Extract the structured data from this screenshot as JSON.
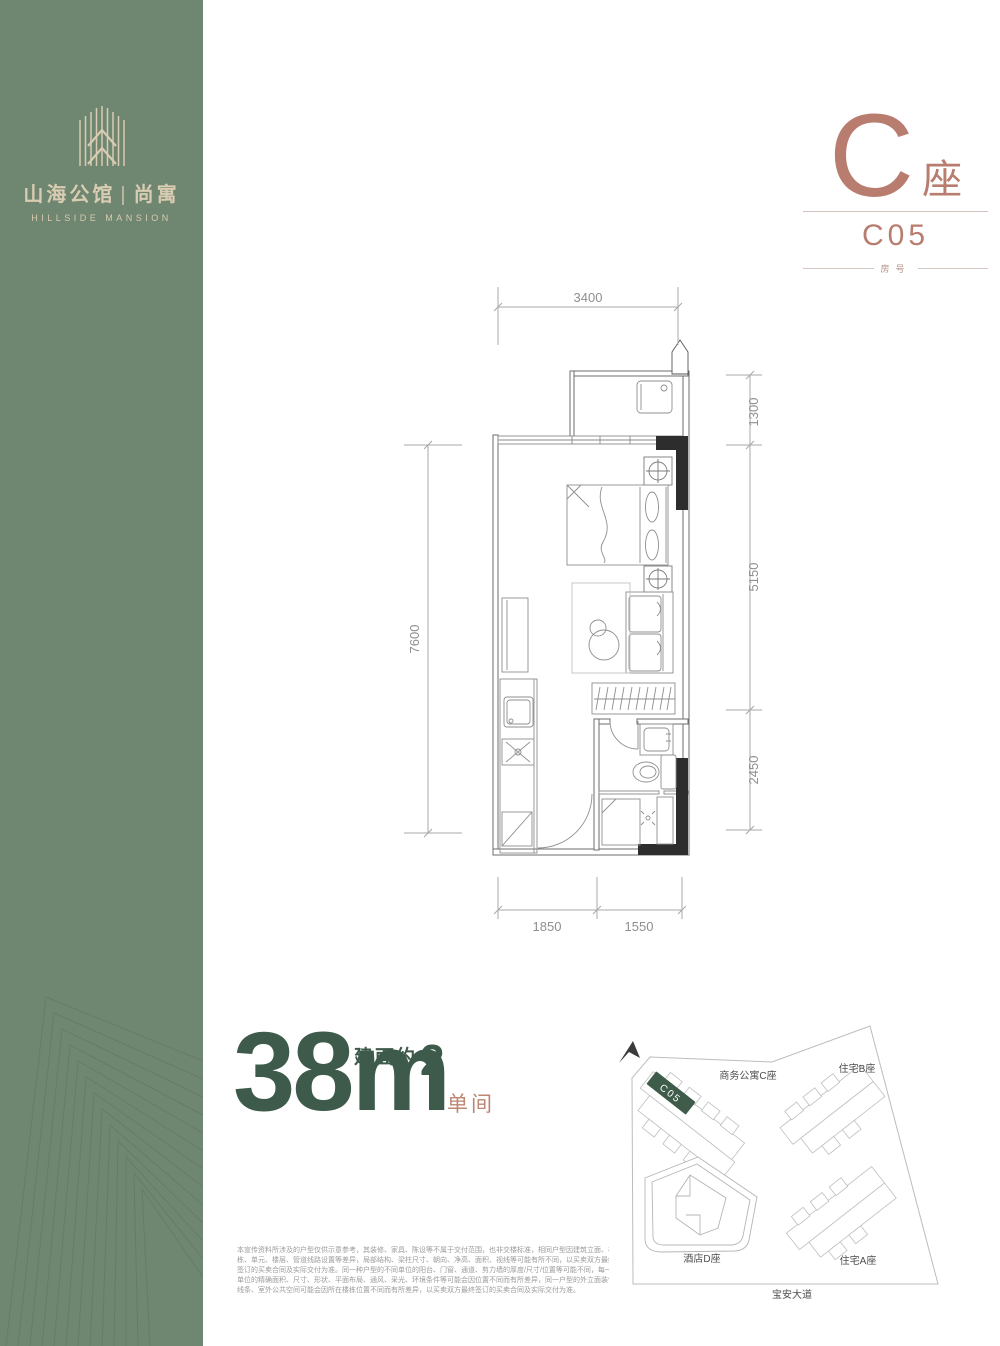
{
  "brand": {
    "name_cn": "山海公馆",
    "separator": "|",
    "sub_name_cn": "尚寓",
    "name_en": "HILLSIDE MANSION"
  },
  "unit_header": {
    "building": "C",
    "building_suffix": "座",
    "unit_number": "C05",
    "unit_number_caption": "房号"
  },
  "floor_plan": {
    "dim_top": "3400",
    "dim_right_1": "1300",
    "dim_right_2": "5150",
    "dim_right_3": "2450",
    "dim_left": "7600",
    "dim_bottom_1": "1850",
    "dim_bottom_2": "1550"
  },
  "area": {
    "value": "38",
    "unit": "m",
    "number_with_unit": "38m",
    "exponent": "2",
    "label_prefix": "建面约",
    "layout_type": "单间"
  },
  "site_map": {
    "building_c_label": "商务公寓C座",
    "building_b_label": "住宅B座",
    "building_d_label": "酒店D座",
    "building_a_label": "住宅A座",
    "road_label": "宝安大道",
    "highlight_unit": "C05"
  },
  "disclaimer": {
    "line1": "本宣传资料所涉及的户型仅供示意参考，其装修、家具、陈设等不属于交付范围，也非交楼标准，相同户型因建筑立面、楼",
    "line2": "栋、单元、楼层、管道线路设置等差异，局部结构、梁柱尺寸、朝向、净高、面积、视线等可能有所不同，以买卖双方最终",
    "line3": "签订的买卖合同及实际交付为准。同一种户型的不同单位的阳台、门窗、通道、剪力墙的厚度/尺寸/位置等可能不同，每一",
    "line4": "单位的精确面积、尺寸、形状、平面布局、通风、采光、环境条件等可能会因位置不同而有所差异，同一户型的外立面装饰",
    "line5": "线条、室外公共空间可能会因所在楼栋位置不同而有所差异，以买卖双方最终签订的买卖合同及实际交付为准。"
  },
  "colors": {
    "sidebar_green": "#6f8670",
    "brand_cream": "#d8ccb2",
    "accent_terracotta": "#b87d6e",
    "accent_green": "#3d5a4b",
    "highlight_green": "#3f5c4b",
    "wall_black": "#2d2d2d"
  }
}
